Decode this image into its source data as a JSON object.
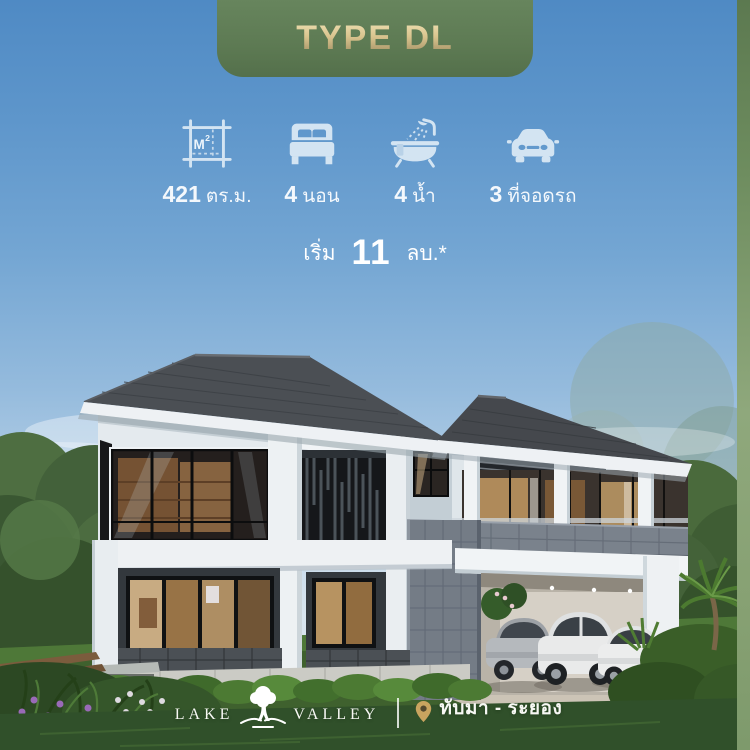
{
  "banner": {
    "label": "TYPE DL"
  },
  "specs": [
    {
      "icon": "area-icon",
      "value": "421",
      "unit": "ตร.ม."
    },
    {
      "icon": "bed-icon",
      "value": "4",
      "unit": "นอน"
    },
    {
      "icon": "bath-icon",
      "value": "4",
      "unit": "น้ำ"
    },
    {
      "icon": "parking-icon",
      "value": "3",
      "unit": "ที่จอดรถ"
    }
  ],
  "price": {
    "prefix": "เริ่ม",
    "amount": "11",
    "suffix": "ลบ.*"
  },
  "footer": {
    "brand_left": "LAKE",
    "brand_right": "VALLEY",
    "location": "ทับมา - ระยอง"
  },
  "colors": {
    "banner_green": "#5d7a53",
    "banner_text_gold": "#d9c48e",
    "sky_top": "#4f8ac4",
    "sky_horizon": "#d9e5ef",
    "accent_strip_green": "#8fa87c",
    "icon_tint": "#d3e4f2",
    "text_white": "#ffffff",
    "lawn_green": "#3f612e",
    "roof_gray": "#4b4f54",
    "pin_gold": "#c9a45f"
  }
}
